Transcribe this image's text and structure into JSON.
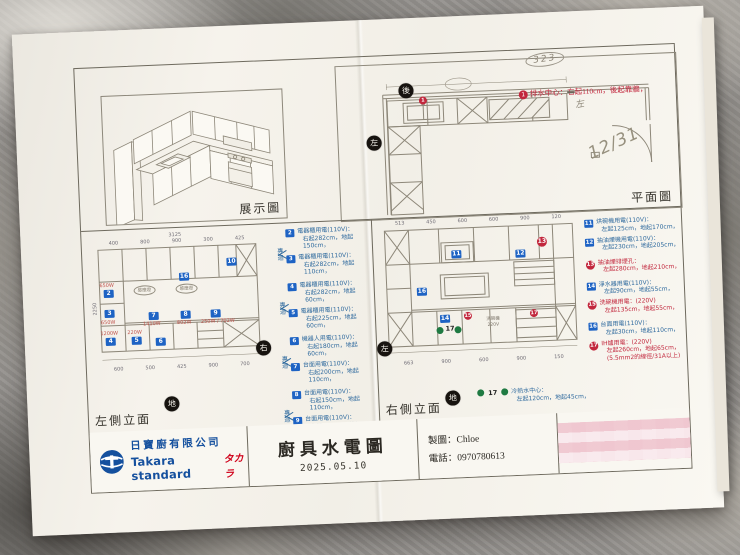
{
  "colors": {
    "marker_blue": "#1e63c4",
    "legend_blue": "#2f6a9e",
    "accent_red": "#c2273d",
    "water_green": "#1f7a42",
    "logo_blue": "#15509e",
    "brand_red": "#d0021b",
    "pencil": "#8d8678"
  },
  "display": {
    "label": "展示圖"
  },
  "plan": {
    "label": "平面圖",
    "back": "後",
    "left": "左",
    "hand_circle": "323",
    "hand_date": "12/31",
    "note": {
      "no": "1",
      "head": "排水中心：",
      "strike": "右",
      "tail": "起110cm，後起靠牆，",
      "hand_fix": "左"
    }
  },
  "left_elev": {
    "label": "左側立面",
    "side": "右",
    "ground": "地",
    "dim_total": "3125",
    "dim_height": "2250",
    "dims_top": [
      "400",
      "800",
      "900",
      "300",
      "425"
    ],
    "dims_bottom": [
      "600",
      "500",
      "425",
      "900",
      "700"
    ],
    "oval_label": "感應燈",
    "markers": {
      "m2": "2",
      "m3": "3",
      "m4": "4",
      "m5": "5",
      "m6": "6",
      "m7": "7",
      "m8": "8",
      "m9": "9",
      "m10": "10",
      "m16": "16"
    },
    "watts": {
      "w2": "650W",
      "w3": "650W",
      "w4": "1200W",
      "w5": "220W",
      "w7": "1410W",
      "w8": "802W",
      "w9": "250W / 702W"
    },
    "pair_label": "專迴",
    "legend": [
      {
        "id": "2",
        "name": "電器櫃用電(110V)：",
        "pos": "右起282cm，地起150cm，"
      },
      {
        "id": "3",
        "name": "電器櫃用電(110V)：",
        "pos": "右起282cm，地起110cm，"
      },
      {
        "id": "4",
        "name": "電器櫃用電(110V)：",
        "pos": "右起282cm，地起60cm，"
      },
      {
        "id": "5",
        "name": "電器櫃用電(110V)：",
        "pos": "右起225cm，地起60cm，"
      },
      {
        "id": "6",
        "name": "機器人用電(110V)：",
        "pos": "右起180cm，地起60cm，"
      },
      {
        "id": "7",
        "name": "台面用電(110V)：",
        "pos": "右起200cm，地起110cm，"
      },
      {
        "id": "8",
        "name": "台面用電(110V)：",
        "pos": "右起150cm，地起110cm，"
      },
      {
        "id": "9",
        "name": "台面用電(110V)：",
        "pos": "右起100cm，地起110cm，"
      },
      {
        "id": "10",
        "name": "感應燈用電(110V)：",
        "pos": "右起140cm，地起165cm，"
      }
    ]
  },
  "right_elev": {
    "label": "右側立面",
    "side": "左",
    "ground": "地",
    "dims_top": [
      "513",
      "450",
      "600",
      "600",
      "900",
      "120"
    ],
    "dims_bottom": [
      "663",
      "900",
      "600",
      "900",
      "150"
    ],
    "appliance_text": "洗碗機 220V",
    "water_no": "17",
    "markers": {
      "m11": "11",
      "m12": "12",
      "m13": "13",
      "m14": "14",
      "m15": "15",
      "m16": "16",
      "m17": "17"
    },
    "legend": [
      {
        "id": "11",
        "name": "烘碗機用電(110V)：",
        "pos": "左起125cm，地起170cm，"
      },
      {
        "id": "12",
        "name": "抽油煙機用電(110V)：",
        "pos": "左起230cm，地起205cm，"
      },
      {
        "id": "13",
        "name": "抽油煙排煙孔：",
        "pos": "左起280cm，地起210cm，"
      },
      {
        "id": "14",
        "name": "淨水器用電(110V)：",
        "pos": "左起90cm，地起55cm，"
      },
      {
        "id": "15",
        "name": "洗碗機用電：(220V)",
        "pos": "左起135cm，地起55cm，"
      },
      {
        "id": "16",
        "name": "台面用電(110V)：",
        "pos": "左起30cm，地起110cm，"
      },
      {
        "id": "17",
        "name": "IH爐用電：(220V)",
        "pos": "左起260cm，地起65cm，",
        "extra": "(5.5mm2的線徑/31A以上)"
      }
    ],
    "water_note": {
      "name": "冷熱水中心：",
      "pos": "左起120cm，地起45cm，"
    }
  },
  "titleblock": {
    "company_cn": "日寶廚有限公司",
    "brand": "Takara standard",
    "brand_jp": "タカラ",
    "title": "廚具水電圖",
    "date": "2025.05.10",
    "drafter_label": "製圖：",
    "drafter": "Chloe",
    "phone_label": "電話：",
    "phone": "0970780613"
  }
}
